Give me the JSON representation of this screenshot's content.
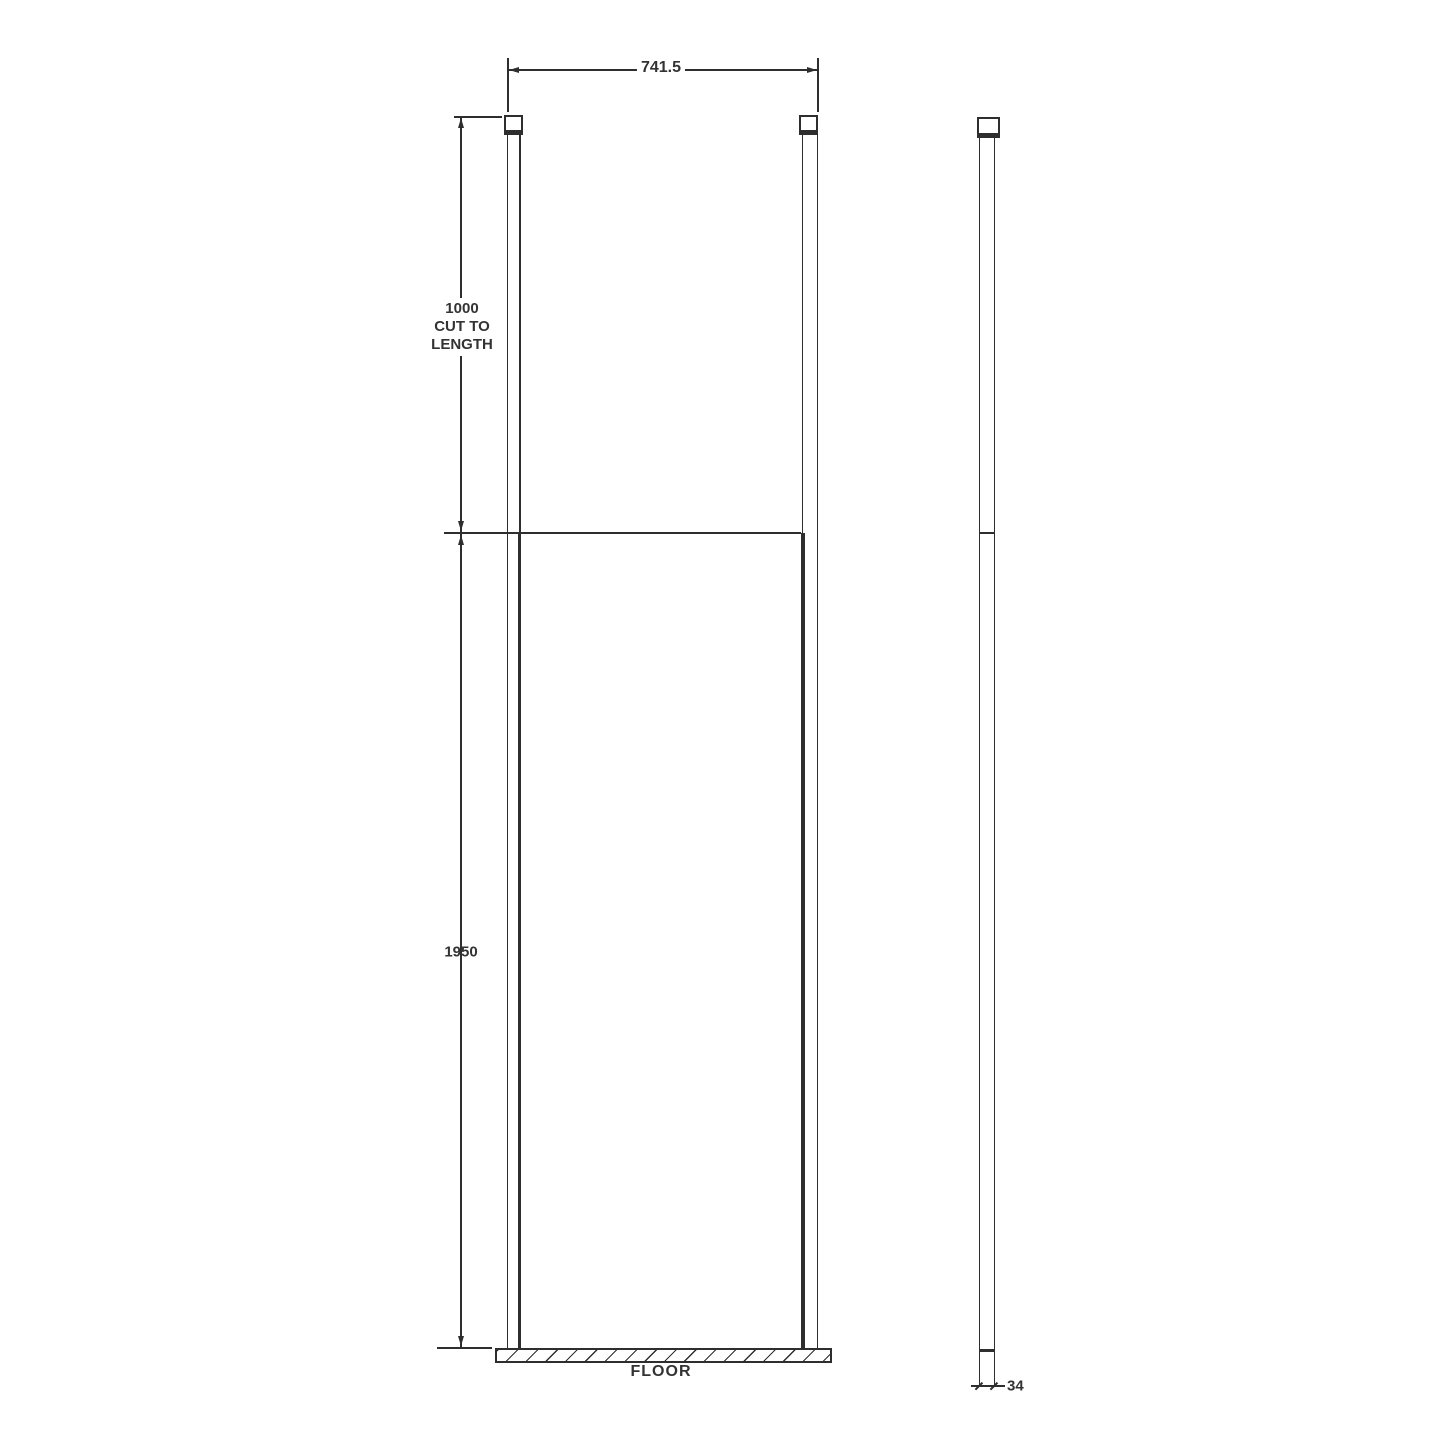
{
  "colors": {
    "bg": "#ffffff",
    "line": "#2e2e2e",
    "text": "#333333"
  },
  "front_view": {
    "width_dimension": {
      "value": "741.5"
    },
    "post_dimension": {
      "line1": "1000",
      "line2": "CUT TO",
      "line3": "LENGTH"
    },
    "panel_dimension": {
      "value": "1950"
    },
    "floor_label": "FLOOR"
  },
  "side_view": {
    "thickness_dimension": {
      "value": "34"
    }
  }
}
